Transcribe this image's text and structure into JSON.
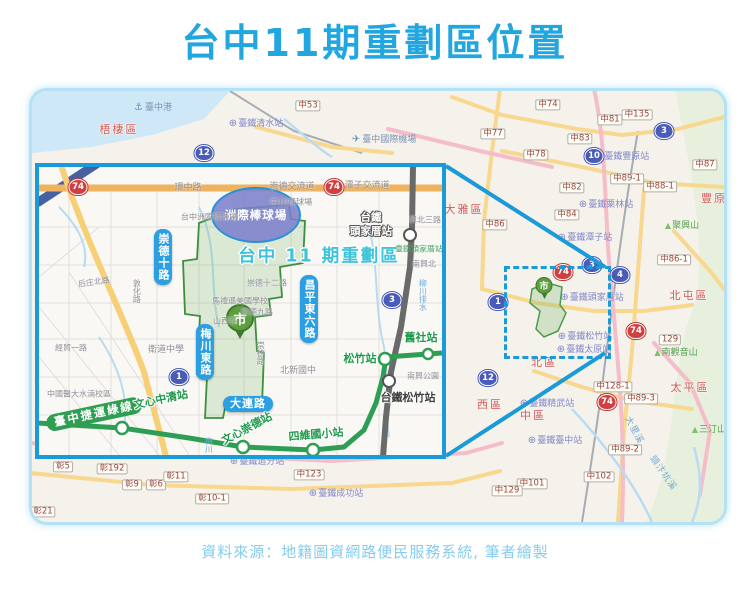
{
  "page": {
    "title": "台中11期重劃區位置",
    "source": "資料來源：地籍圖資網路便民服務系統, 筆者繪製"
  },
  "colors": {
    "title_blue": "#21a6e0",
    "accent_blue": "#1a9ad8",
    "pill_blue": "#2b9fe1",
    "mrt_green": "#2e9e52",
    "zone_green": "#3e8e41",
    "zone_title_cyan": "#3ec4da",
    "district_red": "#d2595a",
    "station_purple": "#8187c6",
    "road_label_brown": "#99463a"
  },
  "icons": {
    "rail_station": "⊕",
    "anchor": "⚓",
    "airplane": "✈",
    "mountain": "▲",
    "city_marker": "市"
  },
  "inset": {
    "stadium_label": "洲際棒球場",
    "zone_label": "台中 11 期重劃區",
    "labels": [
      {
        "t": "環中路",
        "x": 149,
        "y": 22,
        "cls": "g"
      },
      {
        "t": "崇德交流道",
        "x": 253,
        "y": 21,
        "cls": "g"
      },
      {
        "t": "潭子交流道",
        "x": 328,
        "y": 20,
        "cls": "g"
      },
      {
        "t": "台中洲際棒球場",
        "x": 170,
        "y": 51,
        "cls": "g",
        "fs": 8
      },
      {
        "t": "中10棒球場",
        "x": 252,
        "y": 36,
        "cls": "g",
        "fs": 8
      },
      {
        "t": "崇德十二路",
        "x": 228,
        "y": 117,
        "cls": "g",
        "fs": 8
      },
      {
        "t": "崇德九路",
        "x": 218,
        "y": 146,
        "cls": "g",
        "fs": 8
      },
      {
        "t": "馬禮遜美國學校",
        "x": 201,
        "y": 135,
        "cls": "g",
        "fs": 8
      },
      {
        "t": "山西路",
        "x": 186,
        "y": 155,
        "cls": "g",
        "fs": 8
      },
      {
        "t": "衛道中學",
        "x": 127,
        "y": 184,
        "cls": "g"
      },
      {
        "t": "北新國中",
        "x": 259,
        "y": 205,
        "cls": "g"
      },
      {
        "t": "南興公園",
        "x": 384,
        "y": 210,
        "cls": "g",
        "fs": 8
      },
      {
        "t": "經貿一路",
        "x": 32,
        "y": 182,
        "cls": "g",
        "fs": 8
      },
      {
        "t": "后庄北路",
        "x": 55,
        "y": 116,
        "cls": "g",
        "fs": 8,
        "r": -8
      },
      {
        "t": "中國醫大水湳校區",
        "x": 40,
        "y": 228,
        "cls": "g",
        "fs": 8
      },
      {
        "t": "興北三路",
        "x": 386,
        "y": 54,
        "cls": "g",
        "fs": 8
      },
      {
        "t": "南興北",
        "x": 385,
        "y": 98,
        "cls": "g",
        "fs": 8
      },
      {
        "t": "敦化路",
        "x": 97,
        "y": 124,
        "cls": "g",
        "fs": 8,
        "v": true
      },
      {
        "t": "崇德路",
        "x": 221,
        "y": 186,
        "cls": "g",
        "fs": 8,
        "v": true
      },
      {
        "t": "臺鐵頭家厝站",
        "x": 380,
        "y": 83,
        "cls": "gg"
      },
      {
        "t": "柳川排水",
        "x": 383,
        "y": 128,
        "cls": "wl",
        "v": true
      },
      {
        "t": "梅川",
        "x": 169,
        "y": 278,
        "cls": "wl",
        "v": true
      },
      {
        "t": "崇德十路",
        "x": 124,
        "y": 90,
        "cls": "pb",
        "v": true
      },
      {
        "t": "昌平東六路",
        "x": 270,
        "y": 142,
        "cls": "pb",
        "v": true
      },
      {
        "t": "梅川東路",
        "x": 166,
        "y": 185,
        "cls": "pb",
        "v": true
      },
      {
        "t": "大連路",
        "x": 209,
        "y": 237,
        "cls": "pb"
      },
      {
        "t": "臺中捷運綠線",
        "x": 55,
        "y": 247,
        "cls": "pg",
        "r": -12
      },
      {
        "t": "文心中清站",
        "x": 122,
        "y": 233,
        "cls": "ms",
        "r": -12
      },
      {
        "t": "文心崇德站",
        "x": 208,
        "y": 262,
        "cls": "ms",
        "r": -28
      },
      {
        "t": "四維國小站",
        "x": 277,
        "y": 268,
        "cls": "ms",
        "r": -5
      },
      {
        "t": "松竹站",
        "x": 321,
        "y": 192,
        "cls": "ms"
      },
      {
        "t": "舊社站",
        "x": 382,
        "y": 171,
        "cls": "ms"
      },
      {
        "t": "台鐵松竹站",
        "x": 369,
        "y": 231,
        "cls": "rd"
      },
      {
        "t": "台鐵\n頭家厝站",
        "x": 332,
        "y": 58,
        "cls": "rw"
      }
    ],
    "shields": [
      {
        "t": "74",
        "x": 39,
        "y": 20,
        "cls": "red"
      },
      {
        "t": "74",
        "x": 295,
        "y": 20,
        "cls": "red"
      },
      {
        "t": "1",
        "x": 140,
        "y": 210,
        "cls": "blue"
      },
      {
        "t": "3",
        "x": 353,
        "y": 133,
        "cls": "blue"
      }
    ]
  },
  "overview": {
    "road_labels": [
      {
        "t": "中53",
        "x": 276,
        "y": 15
      },
      {
        "t": "中74",
        "x": 516,
        "y": 14
      },
      {
        "t": "中81",
        "x": 578,
        "y": 29
      },
      {
        "t": "中135",
        "x": 605,
        "y": 24
      },
      {
        "t": "中77",
        "x": 461,
        "y": 43
      },
      {
        "t": "中83",
        "x": 548,
        "y": 48
      },
      {
        "t": "中78",
        "x": 504,
        "y": 64
      },
      {
        "t": "中87",
        "x": 673,
        "y": 74
      },
      {
        "t": "中89-1",
        "x": 595,
        "y": 88
      },
      {
        "t": "中88-1",
        "x": 628,
        "y": 96
      },
      {
        "t": "中82",
        "x": 540,
        "y": 97
      },
      {
        "t": "中84",
        "x": 535,
        "y": 124
      },
      {
        "t": "中86",
        "x": 463,
        "y": 134
      },
      {
        "t": "中86-1",
        "x": 642,
        "y": 169
      },
      {
        "t": "129",
        "x": 638,
        "y": 249
      },
      {
        "t": "中128-1",
        "x": 581,
        "y": 296
      },
      {
        "t": "中89-3",
        "x": 609,
        "y": 308
      },
      {
        "t": "中89-2",
        "x": 593,
        "y": 359
      },
      {
        "t": "中102",
        "x": 567,
        "y": 386
      },
      {
        "t": "中101",
        "x": 500,
        "y": 393
      },
      {
        "t": "中129",
        "x": 475,
        "y": 400
      },
      {
        "t": "中123",
        "x": 277,
        "y": 384
      },
      {
        "t": "彰5",
        "x": 31,
        "y": 376
      },
      {
        "t": "彰192",
        "x": 80,
        "y": 378
      },
      {
        "t": "彰9",
        "x": 100,
        "y": 394
      },
      {
        "t": "彰6",
        "x": 124,
        "y": 394
      },
      {
        "t": "彰11",
        "x": 144,
        "y": 386
      },
      {
        "t": "彰10-1",
        "x": 180,
        "y": 408
      },
      {
        "t": "彰21",
        "x": 11,
        "y": 421
      }
    ],
    "districts": [
      {
        "t": "梧棲區",
        "x": 87,
        "y": 39
      },
      {
        "t": "大雅區",
        "x": 432,
        "y": 119
      },
      {
        "t": "豐原",
        "x": 682,
        "y": 108
      },
      {
        "t": "北屯區",
        "x": 657,
        "y": 205
      },
      {
        "t": "北區",
        "x": 512,
        "y": 272
      },
      {
        "t": "西區",
        "x": 458,
        "y": 314
      },
      {
        "t": "中區",
        "x": 501,
        "y": 325
      },
      {
        "t": "太平區",
        "x": 658,
        "y": 297
      }
    ],
    "stations": [
      {
        "t": "臺鐵清水站",
        "x": 224,
        "y": 33,
        "icon": "rail_station"
      },
      {
        "t": "臺鐵豐原站",
        "x": 590,
        "y": 66,
        "icon": "rail_station"
      },
      {
        "t": "臺鐵栗林站",
        "x": 574,
        "y": 114,
        "icon": "rail_station"
      },
      {
        "t": "臺鐵潭子站",
        "x": 553,
        "y": 147,
        "icon": "rail_station"
      },
      {
        "t": "臺鐵頭家厝站",
        "x": 560,
        "y": 207,
        "icon": "rail_station"
      },
      {
        "t": "臺鐵松竹站",
        "x": 553,
        "y": 246,
        "icon": "rail_station"
      },
      {
        "t": "臺鐵太原站",
        "x": 552,
        "y": 259,
        "icon": "rail_station"
      },
      {
        "t": "臺鐵精武站",
        "x": 515,
        "y": 313,
        "icon": "rail_station"
      },
      {
        "t": "臺鐵臺中站",
        "x": 523,
        "y": 350,
        "icon": "rail_station"
      },
      {
        "t": "臺鐵追分站",
        "x": 225,
        "y": 371,
        "icon": "rail_station"
      },
      {
        "t": "臺鐵成功站",
        "x": 304,
        "y": 403,
        "icon": "rail_station"
      }
    ],
    "pois": [
      {
        "t": "臺中港",
        "x": 121,
        "y": 17,
        "icon": "anchor"
      },
      {
        "t": "臺中國際機場",
        "x": 352,
        "y": 49,
        "icon": "airplane"
      }
    ],
    "mountains": [
      {
        "t": "聚興山",
        "x": 650,
        "y": 136,
        "icon": "mountain"
      },
      {
        "t": "南觀音山",
        "x": 644,
        "y": 263,
        "icon": "mountain"
      },
      {
        "t": "三汀山",
        "x": 677,
        "y": 340,
        "icon": "mountain"
      }
    ],
    "rivers": [
      {
        "t": "大里溪",
        "x": 601,
        "y": 340,
        "r": 62
      },
      {
        "t": "頭汴坑溪",
        "x": 630,
        "y": 383,
        "r": 55
      }
    ],
    "shields": [
      {
        "t": "12",
        "x": 172,
        "y": 62,
        "cls": "blue"
      },
      {
        "t": "3",
        "x": 632,
        "y": 40,
        "cls": "blue"
      },
      {
        "t": "10",
        "x": 562,
        "y": 65,
        "cls": "blue"
      },
      {
        "t": "3",
        "x": 560,
        "y": 174,
        "cls": "blue"
      },
      {
        "t": "4",
        "x": 588,
        "y": 184,
        "cls": "blue"
      },
      {
        "t": "1",
        "x": 466,
        "y": 211,
        "cls": "blue"
      },
      {
        "t": "12",
        "x": 456,
        "y": 287,
        "cls": "blue"
      },
      {
        "t": "74",
        "x": 531,
        "y": 181,
        "cls": "red"
      },
      {
        "t": "74",
        "x": 604,
        "y": 240,
        "cls": "red"
      },
      {
        "t": "74",
        "x": 575,
        "y": 311,
        "cls": "red"
      }
    ]
  }
}
